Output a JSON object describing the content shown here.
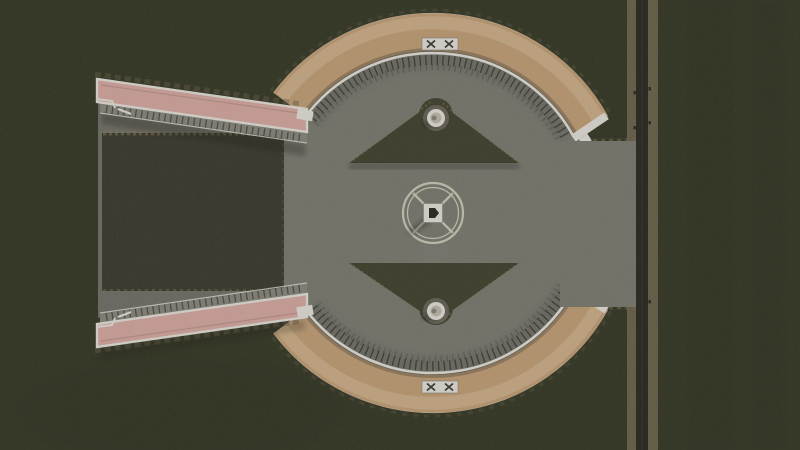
{
  "scene": {
    "title": "aerial-top-down-game-view",
    "description": "Top-down aerial view of a circular sand-colored elevated boardwalk plaza with two pink access ramps on the left, a central statue monument with circular path, two triangular lawns with fountains, a concrete plaza connecting to a vertical rural road on the right, surrounded by dark farmland",
    "features": {
      "terrain": "dark farmland field",
      "upper_ramp": "elevated pedestrian ramp (pink deck, white railings)",
      "lower_ramp": "elevated pedestrian ramp (pink deck, white railings)",
      "upper_boardwalk": "curved sand boardwalk arc with white inner railing and fence posts",
      "lower_boardwalk": "curved sand boardwalk arc with white inner railing and fence posts",
      "upper_gate": "white gate structure with x-braces at top of arc",
      "lower_gate": "white gate structure with x-braces at bottom of arc",
      "plaza": "concrete plaza inside the circle extending to road",
      "upper_lawn": "triangular lawn with round fountain",
      "lower_lawn": "triangular lawn with round fountain",
      "monument": "central statue on white base inside circular path with X walkways",
      "road": "vertical two-lane asphalt road with gravel shoulders and fence posts",
      "grass_court": "dark grass rectangle between the two ramps"
    }
  },
  "colors": {
    "terrain": "#333522",
    "terrain-dark": "#2b2d1c",
    "grass-patch": "#3a392a",
    "lawn": "#42402c",
    "dirt": "#8a7c5c",
    "dirt-soft": "#6b6349",
    "plaza": "#7f7f75",
    "plaza-light": "#8c8c82",
    "apron": "#75756c",
    "boardwalk": "#cda77c",
    "boardwalk-light": "#ddbe93",
    "ramp-deck": "#e2b2a9",
    "ramp-deck-edge": "#c2948b",
    "white": "#f2efe6",
    "ink": "#26261e",
    "asphalt": "#26261f",
    "shoulder": "#746b51",
    "monument-line": "#d9d6c0",
    "fountain-basin": "#c9c4b4",
    "fountain-core": "#8f8a7a",
    "shadow": "#17170f"
  }
}
